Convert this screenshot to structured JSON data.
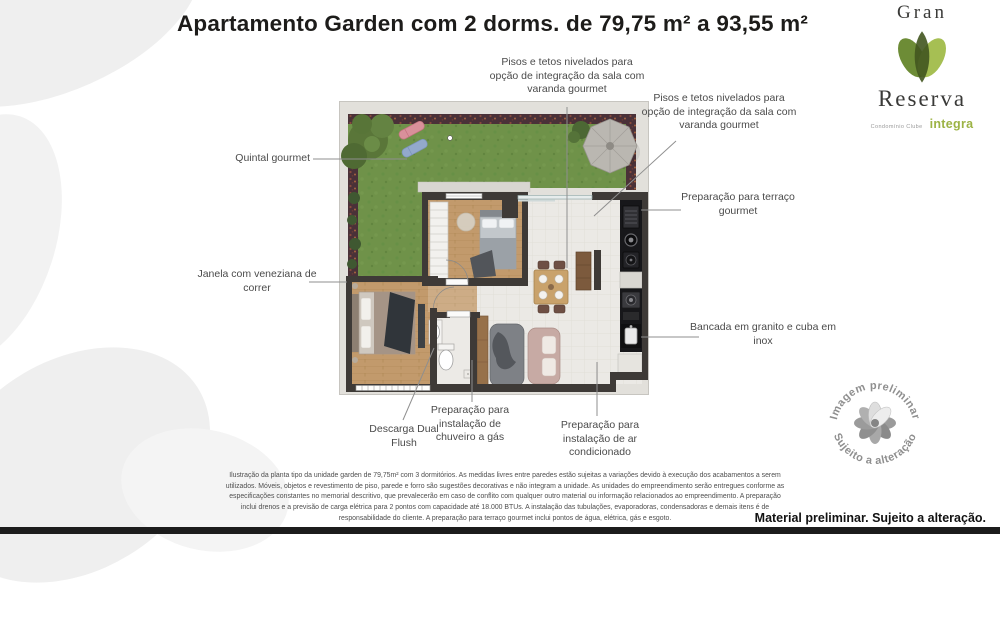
{
  "title": "Apartamento Garden com 2 dorms. de 79,75 m² a 93,55 m²",
  "logo": {
    "name_top": "Gran",
    "name_bottom": "Reserva",
    "tagline": "Condomínio Clube",
    "brand": "integra"
  },
  "callouts": {
    "integration_top": "Pisos e tetos nivelados para opção de integração da sala com varanda gourmet",
    "integration_right": "Pisos e tetos nivelados para opção de integração da sala com varanda gourmet",
    "quintal": "Quintal gourmet",
    "janela": "Janela com veneziana de correr",
    "terraco": "Preparação para terraço gourmet",
    "bancada": "Bancada em granito e cuba em inox",
    "descarga": "Descarga Dual Flush",
    "chuveiro": "Preparação para instalação de chuveiro a gás",
    "ar_condicionado": "Preparação para instalação de ar condicionado"
  },
  "watermark": {
    "arc_top": "Imagem preliminar",
    "arc_bottom": "Sujeito a alteração"
  },
  "footer": {
    "disclaimer": "Ilustração da planta tipo da unidade garden de 79,75m² com 3 dormitórios. As medidas livres entre paredes estão sujeitas a variações devido à execução dos acabamentos a serem utilizados. Móveis, objetos e revestimento de piso, parede e forro são sugestões decorativas e não integram a unidade. As unidades do empreendimento serão entregues conforme as especificações constantes no memorial descritivo, que prevalecerão em caso de conflito com qualquer outro material ou informação relacionados ao empreendimento. A preparação inclui drenos e a previsão de carga elétrica para 2 pontos com capacidade até 18.000 BTUs. A instalação das tubulações, evaporadoras, condensadoras e demais itens é de responsabilidade do cliente. A preparação para terraço gourmet inclui pontos de água, elétrica, gás e esgoto.",
    "notice": "Material preliminar. Sujeito a alteração."
  },
  "colors": {
    "brand_green": "#9cb344",
    "logo_leaf_dark": "#41551f",
    "logo_leaf_mid": "#6d8c36",
    "logo_leaf_light": "#a6bf53",
    "wall": "#3e3a37",
    "grass": "#6f9249",
    "wood_floor": "#c29a6c",
    "kitchen_counter": "#17171a",
    "title_text": "#1d1c1a",
    "label_text": "#4b4b4b"
  }
}
